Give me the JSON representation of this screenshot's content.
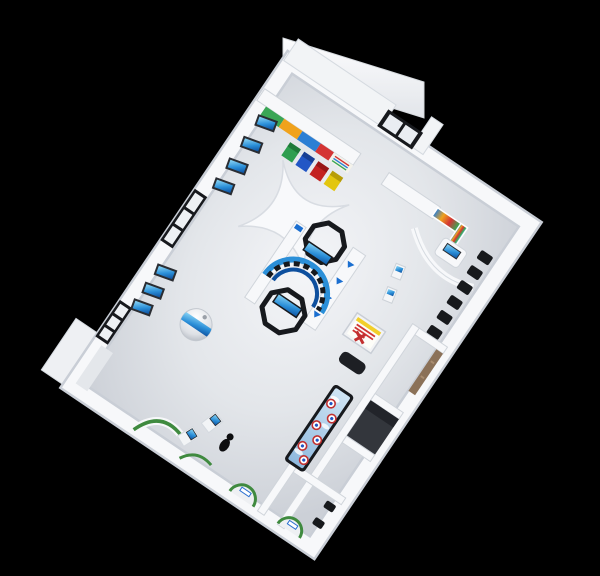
{
  "scene": {
    "type": "isometric-3d-render",
    "subject": "science exhibition hall floor plan, bird's-eye 3D render on black backdrop",
    "background": "#000000"
  },
  "palette": {
    "background": "#000000",
    "wall_white": "#f7f8fa",
    "wall_edge": "#c9ced6",
    "floor_light": "#f2f3f6",
    "floor_dark": "#d3d7dd",
    "frame_black": "#17191d",
    "glass_light": "#e9edf2",
    "screen_blue": "#2b8fd8",
    "screen_blue_dark": "#0d4f9e",
    "bin_green": "#2e9e4f",
    "bin_green_lid": "#1e7a39",
    "bin_blue": "#2256c5",
    "bin_blue_lid": "#173e94",
    "bin_red": "#c32221",
    "bin_red_lid": "#991616",
    "bin_yellow": "#e3c60f",
    "bin_yellow_lid": "#b79d08",
    "stripe_green": "#3aa655",
    "stripe_orange": "#f0a21c",
    "stripe_blue": "#2b7fd4",
    "stripe_red": "#d43434",
    "stripe_info": "#f3f2ea",
    "accent_green": "#3f8a3f",
    "seat_black": "#17191c",
    "wood": "#8b7158",
    "sky_table_frame": "#17191d",
    "poster_yellow": "#f2cf2a",
    "poster_red": "#cf3434",
    "storage_dark": "#33363c",
    "bench_black": "#1d1f24",
    "person_black": "#0d0d0f"
  },
  "objects": {
    "tall_wall_panel": {
      "label": "tall exterior wall panel behind info wall"
    },
    "entrance_door": {
      "label": "black-framed glass entrance door",
      "panes": 2
    },
    "info_wall": {
      "label": "waste-sorting info wall with colored poster columns",
      "stripe_colors": [
        "green",
        "orange",
        "blue",
        "red",
        "info"
      ]
    },
    "recycle_bins": {
      "label": "recycling bins in front of info wall",
      "count": 4,
      "colors": [
        "green",
        "blue",
        "red",
        "yellow"
      ]
    },
    "windows": [
      {
        "label": "upper left-wall window",
        "panes": 3
      },
      {
        "label": "lower left-wall window",
        "panes": 3
      }
    ],
    "wall_screens_upper": {
      "label": "tilted blue display screens on upper-left wall",
      "count": 4
    },
    "wall_screens_lower": {
      "label": "tilted blue display screens on lower-left wall",
      "count": 3
    },
    "tunnel_exhibit": {
      "label": "central futuristic tunnel exhibit with X canopy and octagonal rings",
      "rings": 2,
      "chevrons": 4
    },
    "sphere_exhibit": {
      "label": "sphere projection exhibit with blue band"
    },
    "corner_display": {
      "label": "L-shaped colorful poster board in right corner"
    },
    "reception_counter": {
      "label": "curved counter kiosk with screen"
    },
    "curved_partition": {
      "label": "curved white partition wall"
    },
    "theater_seats": {
      "label": "row of black folding seats along right wall",
      "count": 6
    },
    "kiosk_stands": {
      "label": "small freestanding screen stands",
      "count": 2
    },
    "poster_stand": {
      "label": "demo stand with red/yellow poster and red model"
    },
    "bench": {
      "label": "black bench"
    },
    "storage_room": {
      "label": "dark open storage room"
    },
    "wood_shelf": {
      "label": "wooden wall shelf in corridor"
    },
    "bottom_room": {
      "label": "small bottom room with seats and alcove"
    },
    "bottom_seats": {
      "label": "black seats in bottom room",
      "count": 2
    },
    "interactive_table": {
      "label": "sky-print interactive game table",
      "buttons": 6
    },
    "workstations": {
      "label": "small touchscreen desks",
      "count": 2
    },
    "visitor": {
      "label": "dark visitor figure"
    },
    "alcoves": {
      "label": "green-trimmed curved wall alcoves",
      "count": 3
    },
    "wall_jog": {
      "label": "L-shaped exterior wall jog, lower-left"
    }
  }
}
